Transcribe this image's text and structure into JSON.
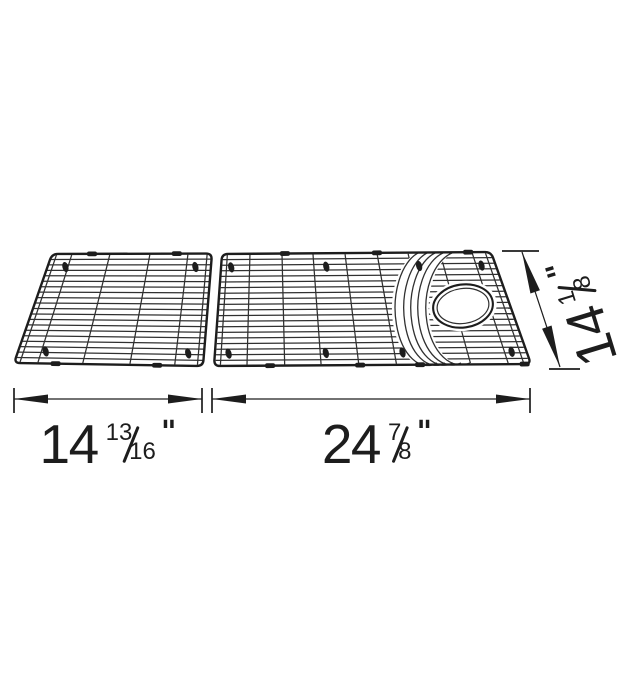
{
  "diagram": {
    "type": "technical dimension drawing",
    "subject": "two-piece wire sink grid set with drain opening, perspective view",
    "background": "#ffffff",
    "line_color": "#303030",
    "frame_color": "#1d1d1d"
  },
  "dimensions": {
    "left_grid_width": {
      "whole": "14",
      "numerator": "13",
      "denominator": "16",
      "unit": "\""
    },
    "right_grid_width": {
      "whole": "24",
      "numerator": "7",
      "denominator": "8",
      "unit": "\""
    },
    "grid_depth": {
      "whole": "14",
      "numerator": "1",
      "denominator": "8",
      "unit": "\""
    }
  }
}
